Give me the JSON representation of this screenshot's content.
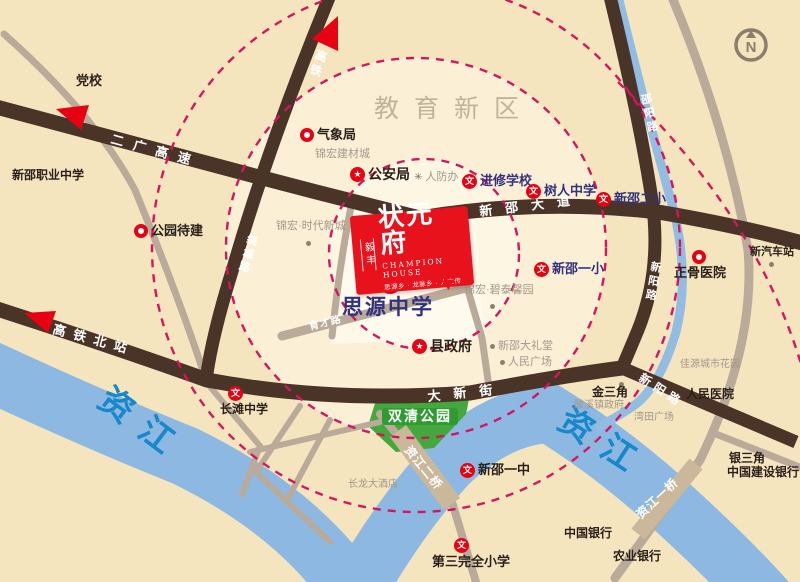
{
  "logo": {
    "brand": "毅丰",
    "title": "状元府",
    "subtitle": "CHAMPION HOUSE",
    "tagline": "思源乡 · 龙脉乡 · 人文传承"
  },
  "compass": {
    "letter": "N"
  },
  "colors": {
    "land": "#f5e5bf",
    "road_dark": "#4a3428",
    "road_gray": "#b9aa99",
    "river": "#8db8e2",
    "river_text": "#1888ca",
    "dash_ring": "#d4155f",
    "accent_red": "#e60213",
    "school_navy": "#32327e",
    "park_green": "#45a83e",
    "bridge_tan": "#cbb89b",
    "gray_text": "#a2988a"
  },
  "river_labels": [
    {
      "label": "资江",
      "x": 96,
      "y": 404,
      "rot": 37
    },
    {
      "label": "资江",
      "x": 556,
      "y": 426,
      "rot": 33
    }
  ],
  "road_labels": [
    {
      "label": "二广高速",
      "x": 110,
      "y": 143,
      "rot": 15,
      "size": 13,
      "ls": 10,
      "vertical": false
    },
    {
      "label": "新邵大道",
      "x": 480,
      "y": 216,
      "rot": -7,
      "size": 13,
      "ls": 13,
      "vertical": false
    },
    {
      "label": "大新街",
      "x": 428,
      "y": 401,
      "rot": -6,
      "size": 13,
      "ls": 13,
      "vertical": false
    },
    {
      "label": "高铁北站",
      "x": 52,
      "y": 333,
      "rot": 15,
      "size": 13,
      "ls": 8,
      "vertical": false
    },
    {
      "label": "高铁",
      "x": 314,
      "y": 58,
      "rot": 20,
      "size": 12,
      "ls": 2,
      "vertical": true
    },
    {
      "label": "绕城路",
      "x": 246,
      "y": 242,
      "rot": 16,
      "size": 11,
      "ls": 2,
      "vertical": true
    },
    {
      "label": "邵阳路",
      "x": 642,
      "y": 104,
      "rot": -12,
      "size": 11,
      "ls": 2,
      "vertical": true
    },
    {
      "label": "新阳路",
      "x": 650,
      "y": 270,
      "rot": 10,
      "size": 11,
      "ls": 2,
      "vertical": true
    },
    {
      "label": "新阳路",
      "x": 638,
      "y": 380,
      "rot": 33,
      "size": 12,
      "ls": 5,
      "vertical": false
    },
    {
      "label": "育才路",
      "x": 310,
      "y": 330,
      "rot": -14,
      "size": 10,
      "ls": 1,
      "vertical": false
    },
    {
      "label": "资江二桥",
      "x": 404,
      "y": 450,
      "rot": 51,
      "size": 12,
      "ls": 1,
      "vertical": false
    },
    {
      "label": "资江一桥",
      "x": 641,
      "y": 519,
      "rot": -43,
      "size": 12,
      "ls": 1,
      "vertical": false
    }
  ],
  "pois": [
    {
      "id": "dangxiao",
      "x": 76,
      "y": 74,
      "marker": "none",
      "label": "党校",
      "cls": "blk b13"
    },
    {
      "id": "xinshao-vocational",
      "x": 12,
      "y": 169,
      "marker": "none",
      "label": "新邵职业中学",
      "cls": "blk b12"
    },
    {
      "id": "education-district",
      "x": 374,
      "y": 96,
      "marker": "none",
      "label": "教育新区",
      "cls": "district"
    },
    {
      "id": "qixiangju",
      "x": 300,
      "y": 128,
      "marker": "ring",
      "label": "气象局",
      "cls": "blk b13"
    },
    {
      "id": "jinhong-jiancaicheng",
      "x": 315,
      "y": 148,
      "marker": "none",
      "label": "锦宏建材城",
      "cls": "gry g11"
    },
    {
      "id": "gonganju",
      "x": 350,
      "y": 167,
      "marker": "star",
      "label": "公安局",
      "cls": "blk b14"
    },
    {
      "id": "renfangban",
      "x": 414,
      "y": 171,
      "marker": "ast",
      "label": "人防办",
      "cls": "gry g11"
    },
    {
      "id": "jinxiu-xuexiao",
      "x": 462,
      "y": 174,
      "marker": "wen",
      "label": "进修学校",
      "cls": "sch"
    },
    {
      "id": "shuren-zhongxue",
      "x": 526,
      "y": 184,
      "marker": "wen",
      "label": "树人中学",
      "cls": "sch"
    },
    {
      "id": "xinshao-erxiao",
      "x": 596,
      "y": 192,
      "marker": "wen",
      "label": "新邵二小",
      "cls": "sch"
    },
    {
      "id": "gongyuan-daijian",
      "x": 134,
      "y": 224,
      "marker": "ring",
      "label": "公园待建",
      "cls": "blk b13"
    },
    {
      "id": "jinhong-shidai",
      "x": 276,
      "y": 220,
      "marker": "none",
      "label": "锦宏·时代新城",
      "cls": "gry g11"
    },
    {
      "id": "xinshao-yixiao",
      "x": 534,
      "y": 262,
      "marker": "wen",
      "label": "新邵一小",
      "cls": "sch"
    },
    {
      "id": "jinhong-bitai",
      "x": 464,
      "y": 284,
      "marker": "none",
      "label": "锦宏·碧泰馨园",
      "cls": "gry g11"
    },
    {
      "id": "siyuan-zhongxue",
      "x": 342,
      "y": 270,
      "marker": "wen-big",
      "label": "思源中学",
      "cls": "sch-big",
      "layout": "col",
      "moff": 36
    },
    {
      "id": "xianzhengfu",
      "x": 412,
      "y": 339,
      "marker": "star",
      "label": "县政府",
      "cls": "blk b14"
    },
    {
      "id": "xinshao-dalitang",
      "x": 490,
      "y": 340,
      "marker": "dot",
      "label": "新邵大礼堂",
      "cls": "gry g11"
    },
    {
      "id": "renmin-guangchang",
      "x": 500,
      "y": 356,
      "marker": "dot",
      "label": "人民广场",
      "cls": "gry g11"
    },
    {
      "id": "zhengu-yiyuan",
      "x": 674,
      "y": 250,
      "marker": "ring",
      "label": "正骨医院",
      "cls": "blk b13",
      "layout": "col",
      "moff": 18
    },
    {
      "id": "xin-qichezhan",
      "x": 750,
      "y": 246,
      "marker": "none",
      "label": "新汽车站",
      "cls": "blk b11"
    },
    {
      "id": "jiayuan-huayuan",
      "x": 680,
      "y": 359,
      "marker": "none",
      "label": "佳源城市花园",
      "cls": "gry g10"
    },
    {
      "id": "changtan-zhongxue",
      "x": 220,
      "y": 386,
      "marker": "wen",
      "label": "长滩中学",
      "cls": "blk b12",
      "layout": "col",
      "moff": 8
    },
    {
      "id": "jinsanjiao",
      "x": 592,
      "y": 386,
      "marker": "none",
      "label": "金三角",
      "cls": "blk b12"
    },
    {
      "id": "suanxi-zhenzhengfu",
      "x": 574,
      "y": 400,
      "marker": "none",
      "label": "酸溪镇政府",
      "cls": "gry g10"
    },
    {
      "id": "wantian-guangchang",
      "x": 634,
      "y": 412,
      "marker": "none",
      "label": "湾田广场",
      "cls": "gry g10"
    },
    {
      "id": "renmin-yiyuan",
      "x": 686,
      "y": 388,
      "marker": "none",
      "label": "人民医院",
      "cls": "blk b12"
    },
    {
      "id": "shuangqing-gongyuan",
      "x": 382,
      "y": 408,
      "marker": "none",
      "label": "双清公园",
      "cls": "park-label"
    },
    {
      "id": "yinsanjiao",
      "x": 729,
      "y": 452,
      "marker": "none",
      "label": "银三角",
      "cls": "blk b12"
    },
    {
      "id": "jianshe-yinhang",
      "x": 727,
      "y": 466,
      "marker": "none",
      "label": "中国建设银行",
      "cls": "blk b12"
    },
    {
      "id": "xinshao-yizhong",
      "x": 460,
      "y": 463,
      "marker": "wen",
      "label": "新邵一中",
      "cls": "blk b13"
    },
    {
      "id": "changlong-dajiudian",
      "x": 348,
      "y": 479,
      "marker": "none",
      "label": "长龙大酒店",
      "cls": "gry g10"
    },
    {
      "id": "zhongguo-yinhang",
      "x": 564,
      "y": 527,
      "marker": "none",
      "label": "中国银行",
      "cls": "blk b12"
    },
    {
      "id": "nongye-yinhang",
      "x": 613,
      "y": 550,
      "marker": "none",
      "label": "农业银行",
      "cls": "blk b12"
    },
    {
      "id": "disan-wanquan-xiaoxue",
      "x": 432,
      "y": 538,
      "marker": "wen",
      "label": "第三完全小学",
      "cls": "blk b13",
      "layout": "col",
      "moff": 22
    }
  ],
  "dots": [
    {
      "x": 306,
      "y": 241
    },
    {
      "x": 490,
      "y": 304
    },
    {
      "x": 769,
      "y": 262
    },
    {
      "x": 619,
      "y": 382
    }
  ]
}
